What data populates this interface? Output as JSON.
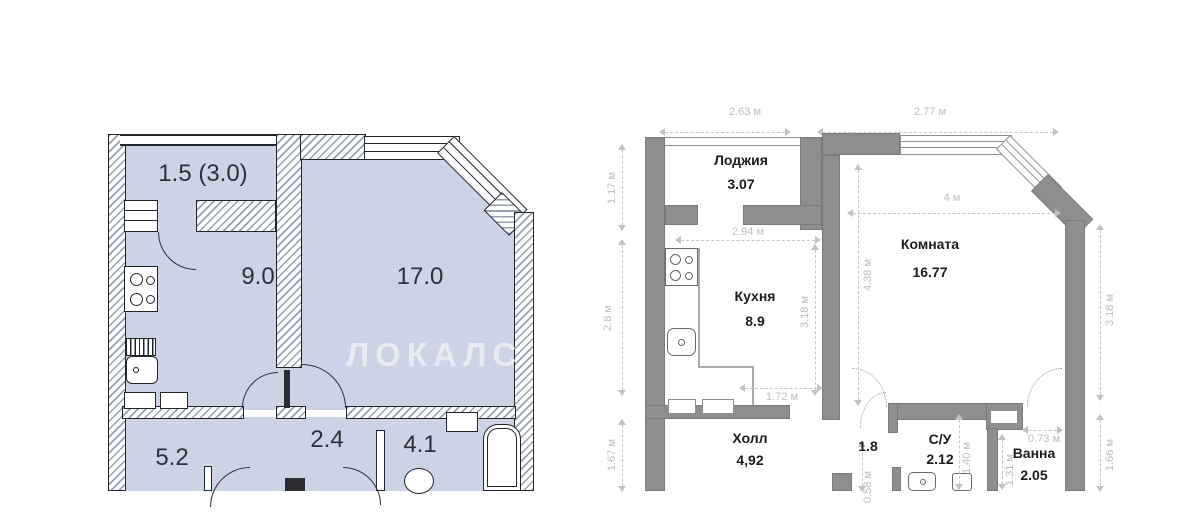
{
  "watermark": "ЛОКАЛС",
  "plan_left": {
    "balcony": "1.5 (3.0)",
    "kitchen": "9.0",
    "living": "17.0",
    "hall": "5.2",
    "corridor": "2.4",
    "bath": "4.1"
  },
  "plan_right": {
    "loggia_name": "Лоджия",
    "loggia_area": "3.07",
    "kitchen_name": "Кухня",
    "kitchen_area": "8.9",
    "room_name": "Комната",
    "room_area": "16.77",
    "hall_name": "Холл",
    "hall_area": "4,92",
    "niche_area": "1.8",
    "wc_name": "С/У",
    "wc_area": "2.12",
    "bath_name": "Ванна",
    "bath_area": "2.05",
    "dim_top_left": "2.63 м",
    "dim_top_right": "2.77 м",
    "dim_left_1": "1.17 м",
    "dim_left_2": "2.8 м",
    "dim_left_3": "1.67 м",
    "dim_right_1": "3.18 м",
    "dim_right_2": "1.66 м",
    "dim_loggia_w": "2.94 м",
    "dim_kitchen_h": "3.18 м",
    "dim_room_w": "4 м",
    "dim_room_h": "4.38 м",
    "dim_kitchen_w": "1.72 м",
    "dim_wc_h": "1.40 м",
    "dim_bath_door": "0.73 м",
    "dim_bath_h": "1.31 м",
    "dim_niche": "0.58 м"
  },
  "colors": {
    "room_fill": "#ccd3e6",
    "blueprint_line": "#22242b",
    "wall_gray": "#8e8e8e",
    "dim_text": "#bdbdbd",
    "watermark": "#e9ebf2"
  }
}
